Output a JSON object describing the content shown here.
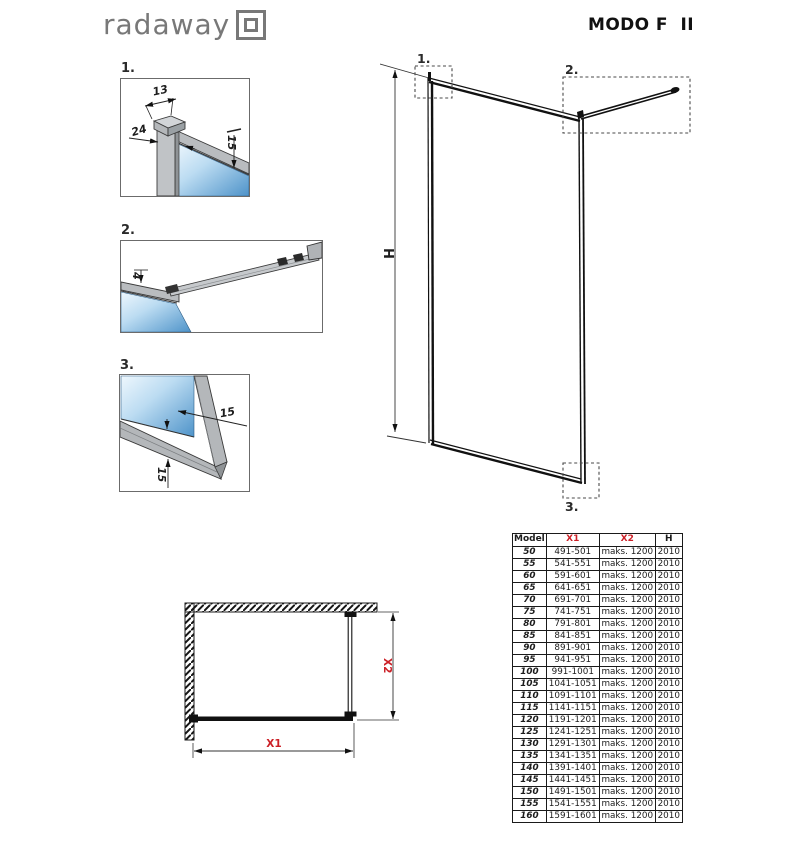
{
  "header": {
    "brand": "radaway",
    "logo_icon": "double-square-logo",
    "title": "MODO F  II"
  },
  "details": [
    {
      "label": "1.",
      "dim_width": "13",
      "dim_depth": "24",
      "dim_overlap": "15"
    },
    {
      "label": "2.",
      "dim_thickness": "4"
    },
    {
      "label": "3.",
      "dim_glass": "15",
      "dim_bottom": "15"
    }
  ],
  "main_drawing": {
    "dim_height": "H",
    "callout_1": "1.",
    "callout_2": "2.",
    "callout_3": "3."
  },
  "plan_drawing": {
    "dim_x1": "X1",
    "dim_x2": "X2"
  },
  "spec_table": {
    "headers": [
      "Model",
      "X1",
      "X2",
      "H"
    ],
    "rows": [
      [
        "50",
        "491-501",
        "maks. 1200",
        "2010"
      ],
      [
        "55",
        "541-551",
        "maks. 1200",
        "2010"
      ],
      [
        "60",
        "591-601",
        "maks. 1200",
        "2010"
      ],
      [
        "65",
        "641-651",
        "maks. 1200",
        "2010"
      ],
      [
        "70",
        "691-701",
        "maks. 1200",
        "2010"
      ],
      [
        "75",
        "741-751",
        "maks. 1200",
        "2010"
      ],
      [
        "80",
        "791-801",
        "maks. 1200",
        "2010"
      ],
      [
        "85",
        "841-851",
        "maks. 1200",
        "2010"
      ],
      [
        "90",
        "891-901",
        "maks. 1200",
        "2010"
      ],
      [
        "95",
        "941-951",
        "maks. 1200",
        "2010"
      ],
      [
        "100",
        "991-1001",
        "maks. 1200",
        "2010"
      ],
      [
        "105",
        "1041-1051",
        "maks. 1200",
        "2010"
      ],
      [
        "110",
        "1091-1101",
        "maks. 1200",
        "2010"
      ],
      [
        "115",
        "1141-1151",
        "maks. 1200",
        "2010"
      ],
      [
        "120",
        "1191-1201",
        "maks. 1200",
        "2010"
      ],
      [
        "125",
        "1241-1251",
        "maks. 1200",
        "2010"
      ],
      [
        "130",
        "1291-1301",
        "maks. 1200",
        "2010"
      ],
      [
        "135",
        "1341-1351",
        "maks. 1200",
        "2010"
      ],
      [
        "140",
        "1391-1401",
        "maks. 1200",
        "2010"
      ],
      [
        "145",
        "1441-1451",
        "maks. 1200",
        "2010"
      ],
      [
        "150",
        "1491-1501",
        "maks. 1200",
        "2010"
      ],
      [
        "155",
        "1541-1551",
        "maks. 1200",
        "2010"
      ],
      [
        "160",
        "1591-1601",
        "maks. 1200",
        "2010"
      ]
    ]
  },
  "colors": {
    "accent_red": "#cc2027",
    "glass_blue_light": "#eef7fd",
    "glass_blue": "#4e93c9",
    "profile_gray": "#b9bcbf",
    "line_dark": "#1c1c1c"
  }
}
